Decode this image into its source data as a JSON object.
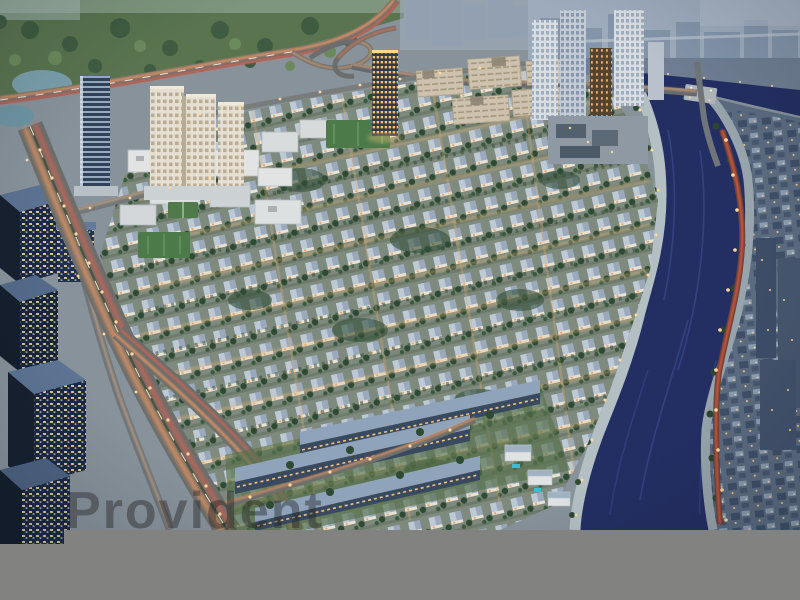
{
  "image": {
    "type": "aerial-dusk-render",
    "subject": "Waterfront master-planned community: villa district beside a curving canal, high-rise towers, highways with light trails, city across the canal"
  },
  "watermark": {
    "text": "Provident",
    "color": "#232323"
  },
  "colors": {
    "base_ground": "#87929a",
    "park_green": "#59744f",
    "tree_dark": "#2e4a33",
    "lake_water": "#7aa0ac",
    "distant_city": "#9dabbc",
    "north_midrise": "#6f7e92",
    "east_city": "#5b6b80",
    "canal_water": "#232f63",
    "canal_ripple": "#3e4e92",
    "promenade": "#b4bfc3",
    "promenade_east": "#98a4ac",
    "bridge": "#aeb6ba",
    "villa_ground": "#7f8a7e",
    "road_gray": "#6b6e6c",
    "trail_orange": "#ff9c5e",
    "trail_red": "#ff5f45",
    "trail_white": "#ffe8c8",
    "street_light": "#ffd9a0",
    "office_facade": "#1c2940",
    "office_roof": "#5c7292",
    "cream_tower": "#e6e0d2",
    "lawn_green": "#57724c",
    "townhouse_roof": "#8fa3ba",
    "townhouse_facade": "#3a4a5e",
    "pool_blue": "#3fb9d6",
    "gray_bar": "#828281"
  },
  "scene": {
    "regions": [
      {
        "name": "parkland",
        "label": "tree-covered park, top left"
      },
      {
        "name": "glass-tower",
        "label": "slender glass tower"
      },
      {
        "name": "cream-tower-complex",
        "label": "cream residential high-rise block"
      },
      {
        "name": "golden-tower",
        "label": "tower with golden lit windows"
      },
      {
        "name": "canal-towers",
        "label": "high-rise cluster beside canal"
      },
      {
        "name": "villa-district",
        "label": "rows of white villas with trees"
      },
      {
        "name": "townhouse-rows",
        "label": "three-storey townhouse rows"
      },
      {
        "name": "office-towers",
        "label": "dark glass office blocks, left edge"
      },
      {
        "name": "boulevard",
        "label": "arterial road with orange light trails"
      },
      {
        "name": "canal",
        "label": "dark blue canal curving to bottom right"
      },
      {
        "name": "east-bank-city",
        "label": "city blocks across the canal"
      },
      {
        "name": "gray-bar",
        "label": "gray masking bar across bottom"
      }
    ]
  }
}
